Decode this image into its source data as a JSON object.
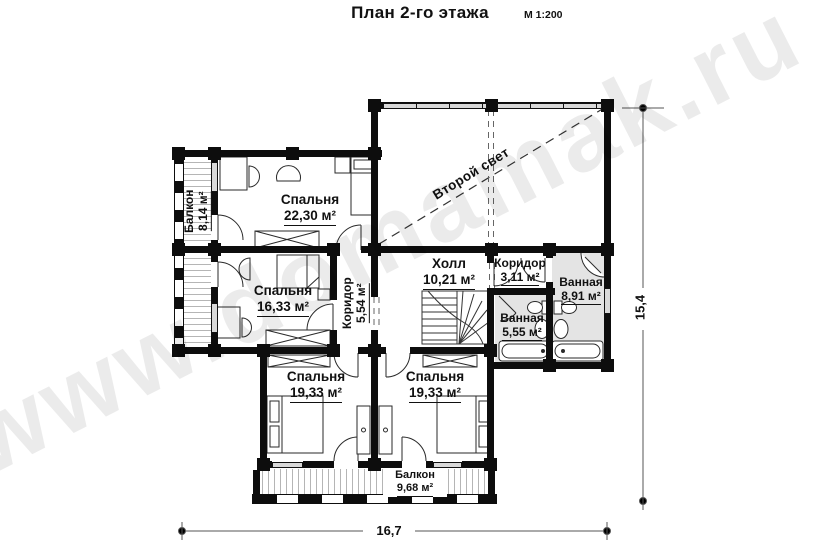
{
  "header": {
    "title": "План 2-го этажа",
    "scale": "М 1:200"
  },
  "watermark": "www.domamak.ru",
  "annotations": {
    "second_light": "Второй свет"
  },
  "dimensions": {
    "horizontal": "16,7",
    "vertical": "15,4"
  },
  "rooms": {
    "bedroom_2230": {
      "name": "Спальня",
      "area": "22,30 м²"
    },
    "bedroom_1633": {
      "name": "Спальня",
      "area": "16,33 м²"
    },
    "balcony_left": {
      "name": "Балкон",
      "area": "8,14 м²"
    },
    "corridor_554": {
      "name": "Коридор",
      "area": "5,54 м²"
    },
    "hall": {
      "name": "Холл",
      "area": "10,21 м²"
    },
    "corridor_311": {
      "name": "Коридор",
      "area": "3,11 м²"
    },
    "bath_891": {
      "name": "Ванная",
      "area": "8,91 м²"
    },
    "bath_555": {
      "name": "Ванная",
      "area": "5,55 м²"
    },
    "bedroom_1933_left": {
      "name": "Спальня",
      "area": "19,33 м²"
    },
    "bedroom_1933_right": {
      "name": "Спальня",
      "area": "19,33 м²"
    },
    "balcony_bottom": {
      "name": "Балкон",
      "area": "9,68 м²"
    }
  },
  "colors": {
    "wall": "#0d0d0d",
    "room_fill": "#ffffff",
    "bath_fill": "#e4e4e4",
    "window_fill": "#d9d9d9",
    "dimension_line": "#555555",
    "watermark": "rgba(0,0,0,0.08)"
  }
}
